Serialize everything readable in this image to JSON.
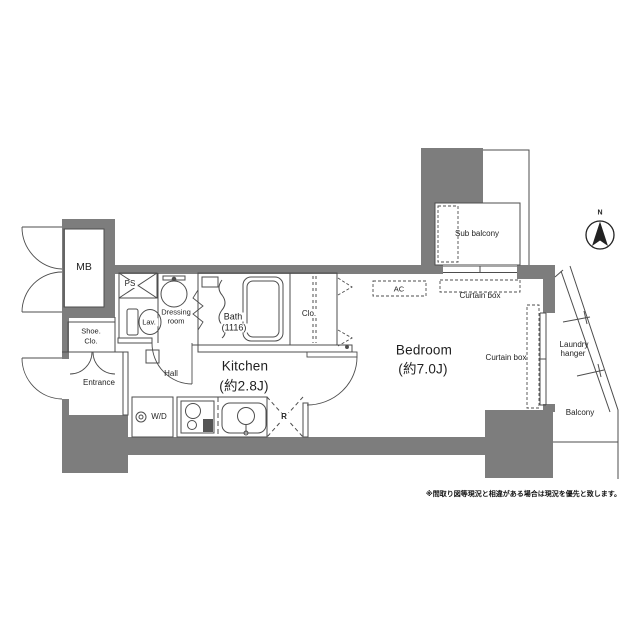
{
  "labels": {
    "mb": "MB",
    "ps": "PS",
    "dressing_line1": "Dressing",
    "dressing_line2": "room",
    "lav": "Lav.",
    "bath_line1": "Bath",
    "bath_line2": "(1116)",
    "shoe_line1": "Shoe.",
    "shoe_line2": "Clo.",
    "entrance": "Entrance",
    "hall": "Hall",
    "kitchen_name": "Kitchen",
    "kitchen_size": "(約2.8J)",
    "bedroom_name": "Bedroom",
    "bedroom_size": "(約7.0J)",
    "clo": "Clo.",
    "wd": "W/D",
    "refrigerator": "R",
    "ac": "AC",
    "sub_balcony": "Sub balcony",
    "curtain_box_top": "Curtain box",
    "curtain_box_right": "Curtain box",
    "laundry_line1": "Laundry",
    "laundry_line2": "hanger",
    "balcony": "Balcony"
  },
  "compass": {
    "north": "N"
  },
  "note": "※間取り図等現況と相違がある場合は現況を優先と致します。",
  "colors": {
    "wall": "#7d7d7d",
    "line": "#4d4d4d",
    "text": "#1f1f1f"
  }
}
